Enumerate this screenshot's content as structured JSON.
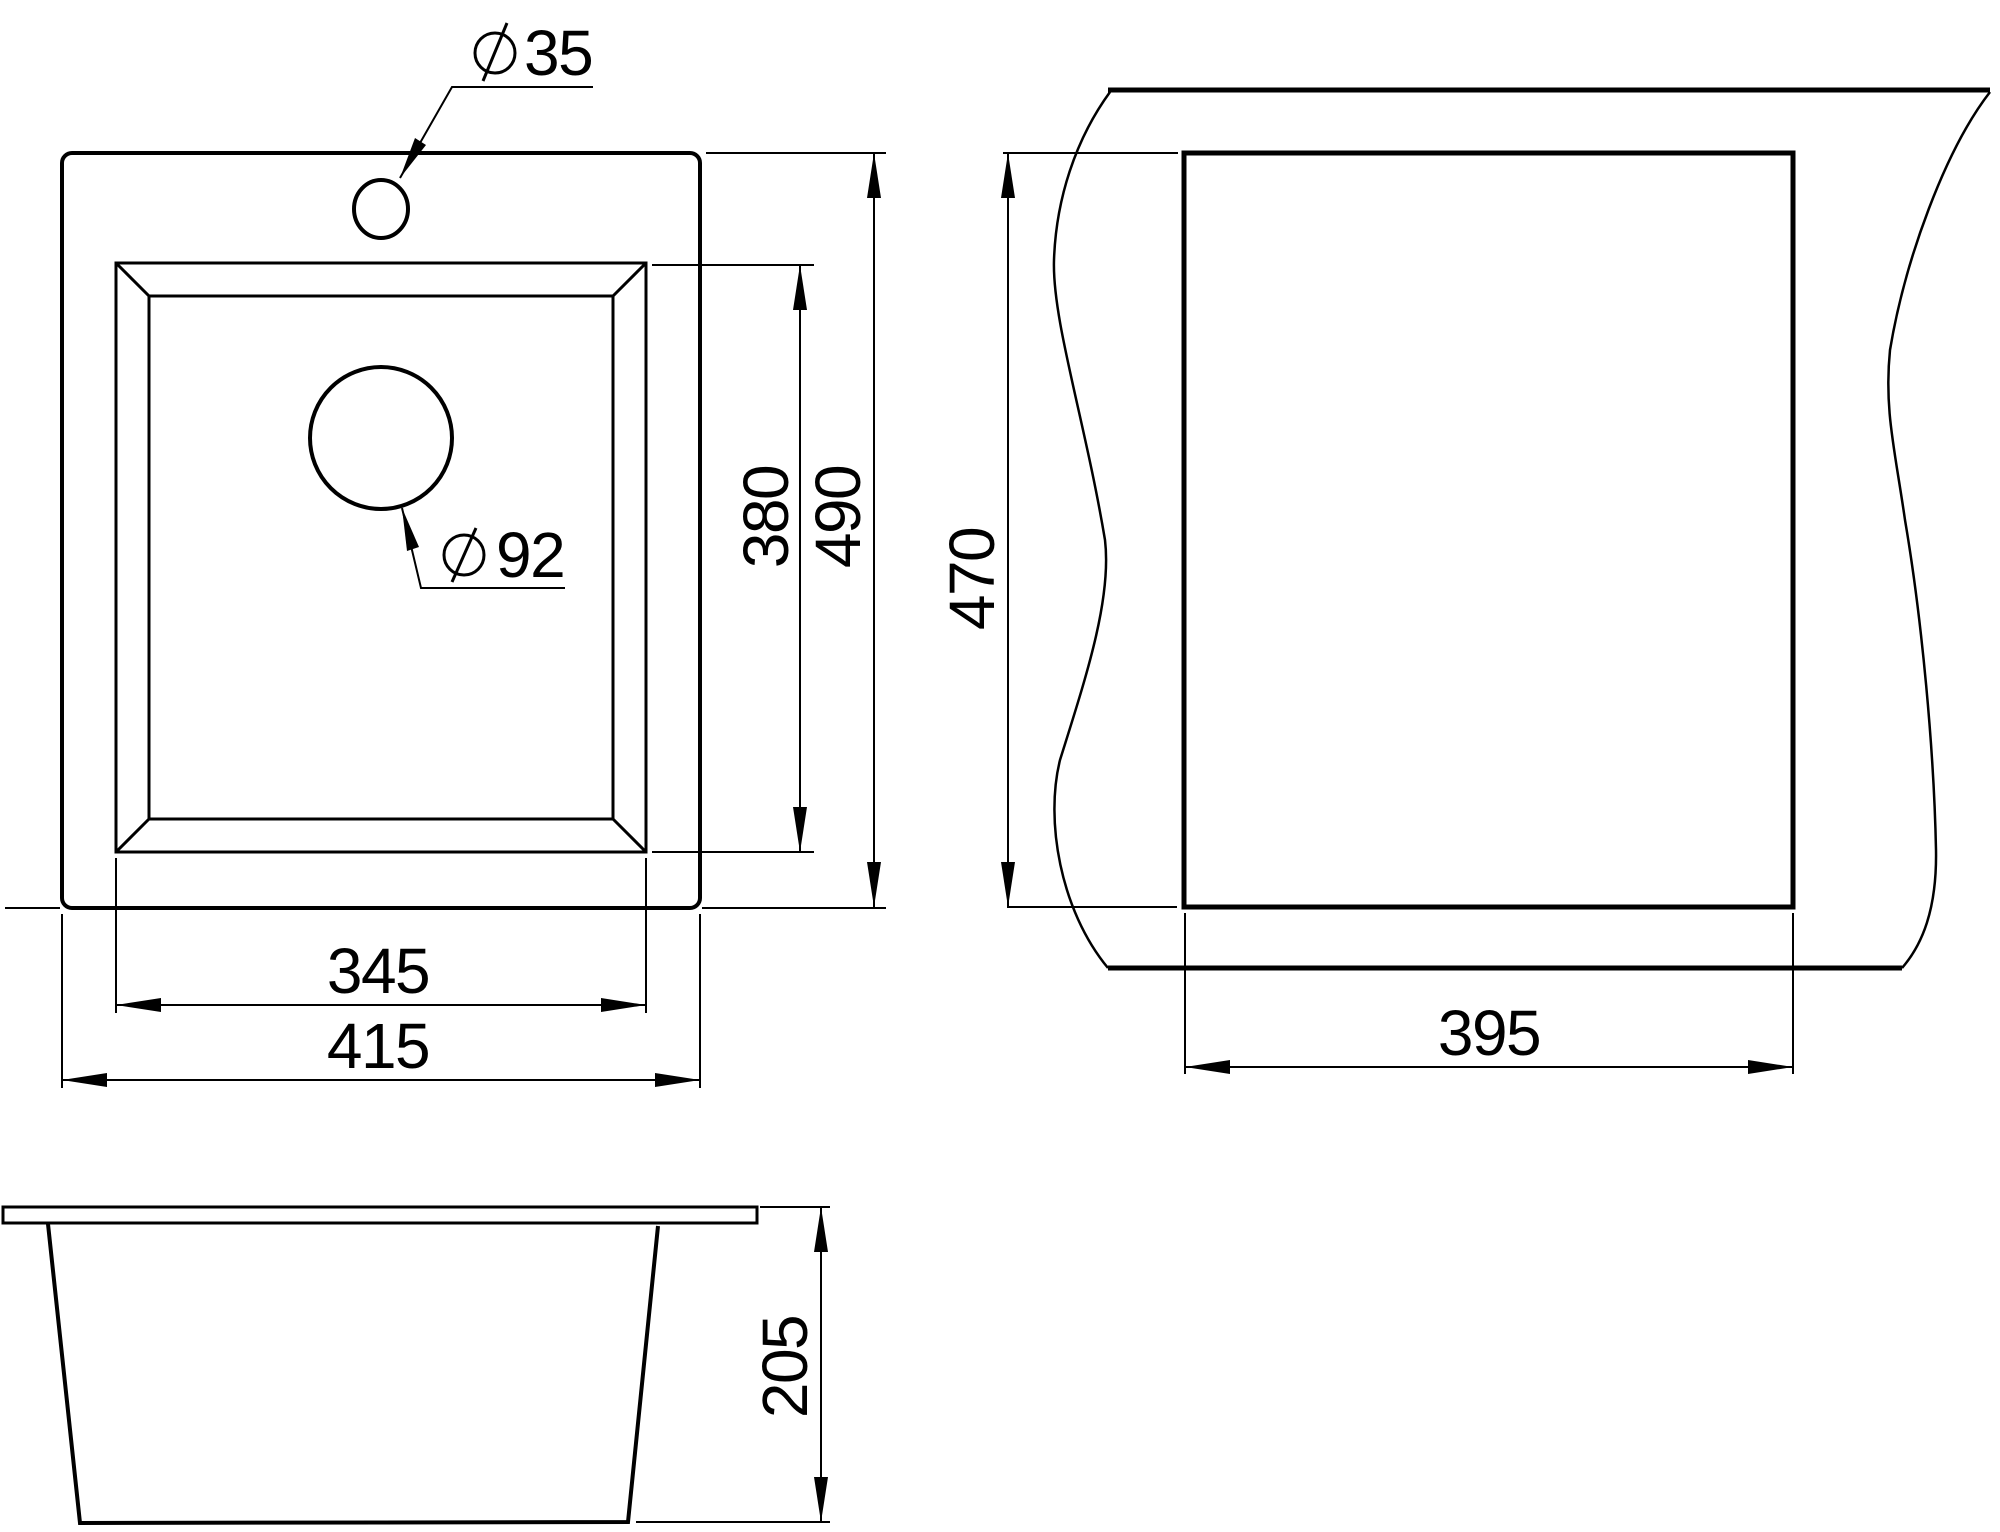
{
  "colors": {
    "line": "#000000",
    "background": "#ffffff"
  },
  "plan_view": {
    "faucet_hole_diameter": "35",
    "drain_hole_diameter": "92",
    "bowl_width": "345",
    "overall_width": "415",
    "bowl_depth": "380",
    "overall_depth": "490"
  },
  "cutout_view": {
    "cutout_depth": "470",
    "cutout_width": "395"
  },
  "side_view": {
    "mounting_height": "205"
  }
}
